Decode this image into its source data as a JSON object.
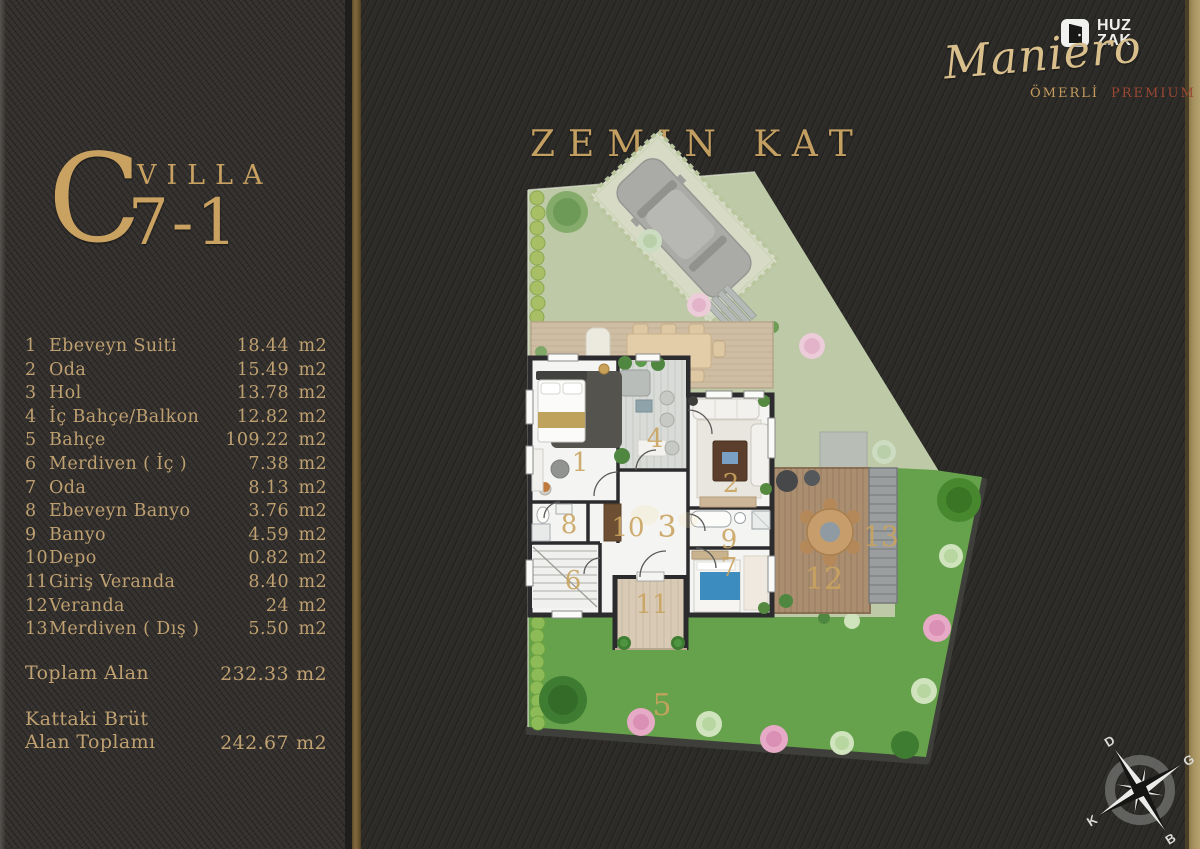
{
  "villa": {
    "letter": "C",
    "word": "VILLA",
    "number": "7-1"
  },
  "floor_title": "ZEMIN KAT",
  "brand": {
    "logo_line1": "HUZ",
    "logo_line2": "ZAK",
    "name": "Maniero",
    "sub1": "ÖMERLİ",
    "sub2": "PREMIUM"
  },
  "rooms": [
    {
      "no": "1",
      "name": "Ebeveyn Suiti",
      "area": "18.44",
      "unit": "m2"
    },
    {
      "no": "2",
      "name": "Oda",
      "area": "15.49",
      "unit": "m2"
    },
    {
      "no": "3",
      "name": "Hol",
      "area": "13.78",
      "unit": "m2"
    },
    {
      "no": "4",
      "name": "İç Bahçe/Balkon",
      "area": "12.82",
      "unit": "m2"
    },
    {
      "no": "5",
      "name": "Bahçe",
      "area": "109.22",
      "unit": "m2"
    },
    {
      "no": "6",
      "name": "Merdiven ( İç )",
      "area": "7.38",
      "unit": "m2"
    },
    {
      "no": "7",
      "name": "Oda",
      "area": "8.13",
      "unit": "m2"
    },
    {
      "no": "8",
      "name": "Ebeveyn Banyo",
      "area": "3.76",
      "unit": "m2"
    },
    {
      "no": "9",
      "name": "Banyo",
      "area": "4.59",
      "unit": "m2"
    },
    {
      "no": "10",
      "name": "Depo",
      "area": "0.82",
      "unit": "m2"
    },
    {
      "no": "11",
      "name": "Giriş Veranda",
      "area": "8.40",
      "unit": "m2"
    },
    {
      "no": "12",
      "name": "Veranda",
      "area": "24",
      "unit": "m2"
    },
    {
      "no": "13",
      "name": "Merdiven ( Dış )",
      "area": "5.50",
      "unit": "m2"
    }
  ],
  "totals": {
    "toplam": {
      "label": "Toplam Alan",
      "area": "232.33",
      "unit": "m2"
    },
    "kattaki": {
      "label_line1": "Kattaki Brüt",
      "label_line2": "Alan Toplamı",
      "area": "242.67",
      "unit": "m2"
    }
  },
  "compass": {
    "top": "D",
    "right": "G",
    "bottom": "B",
    "left": "K"
  },
  "colors": {
    "gold": "#c9a262",
    "bronze_stripe": "#7d6438",
    "page_edge": "#a6925f",
    "pale_lawn": "#bdc9a7",
    "bright_lawn": "#66a14b",
    "deck_wood": "#cfbda3",
    "veranda_wood": "#ab8e6f",
    "premium_text": "#9c4732"
  }
}
